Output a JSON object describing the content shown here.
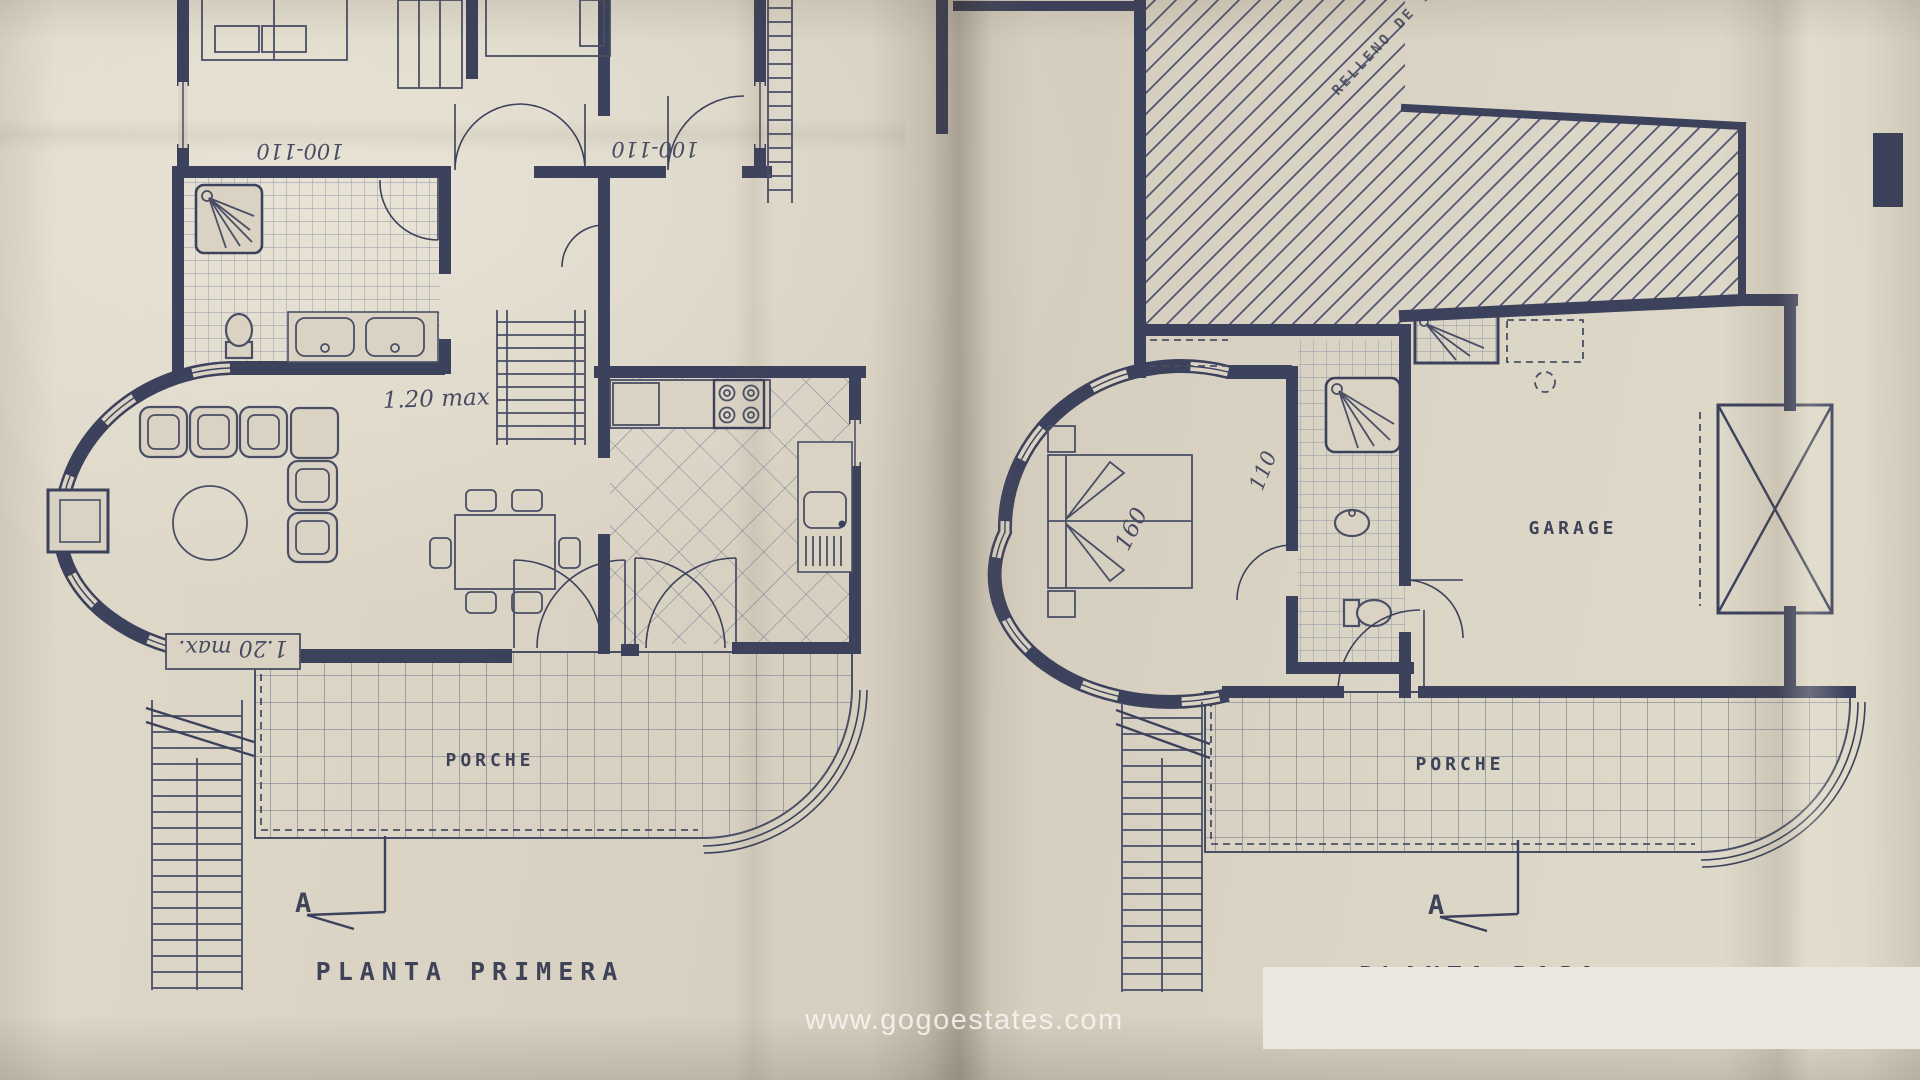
{
  "watermark": {
    "text": "www.gogoestates.com"
  },
  "colors": {
    "paper": "#dad3c4",
    "ink": "#3c415c",
    "tile_line": "#82869c",
    "overlay_box": "#ece8df",
    "watermark_text": "#f5f3ee"
  },
  "plan_left": {
    "title": "PLANTA PRIMERA",
    "porch_label": "PORCHE",
    "section_letter": "A",
    "room_dim_left": "100-110",
    "room_dim_right": "100-110",
    "stairs_note": "1.20 max",
    "living_note": "1.20 max."
  },
  "plan_right": {
    "title": "PLANTA BAJA",
    "garage_label": "GARAGE",
    "porch_label": "PORCHE",
    "section_letter": "A",
    "fill_label": "RELLENO DE TIERRA",
    "bed_dim": "160",
    "bath_dim": "110"
  }
}
